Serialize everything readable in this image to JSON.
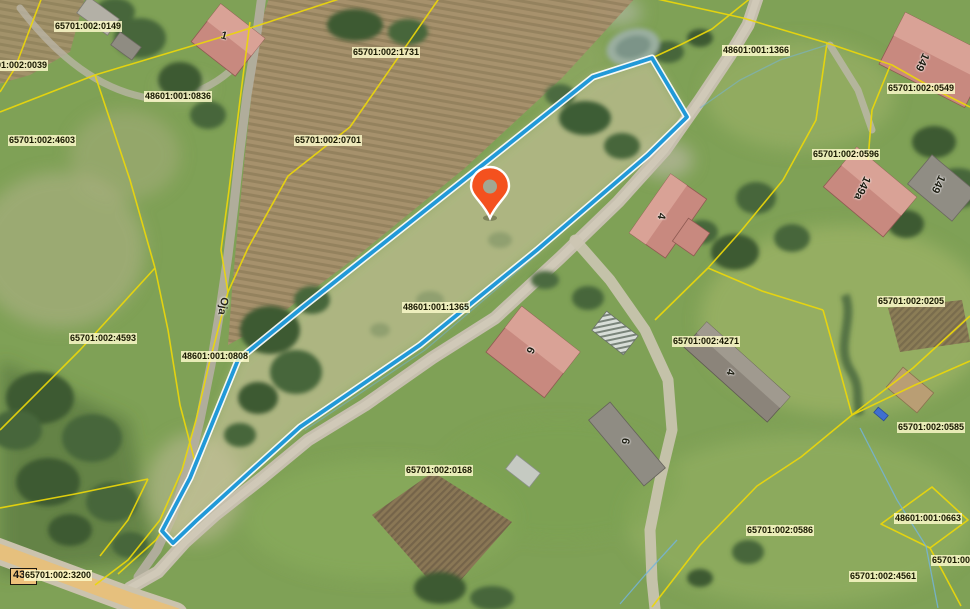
{
  "map": {
    "view": "aerial-cadastral",
    "selected_parcel": {
      "id": "48601:001:1365",
      "outline_color": "#2199d8"
    },
    "pin": {
      "color": "#f4511e"
    },
    "road": {
      "name": "Oja",
      "number": "43"
    },
    "cadastral": {
      "line_color": "#ecd70a",
      "label_background": "#fcf8c8"
    },
    "parcel_labels": [
      {
        "text": "65701:002:0149"
      },
      {
        "text": "65701:002:0039"
      },
      {
        "text": "48601:001:0836"
      },
      {
        "text": "65701:002:4603"
      },
      {
        "text": "65701:002:1731"
      },
      {
        "text": "65701:002:0701"
      },
      {
        "text": "48601:001:1366"
      },
      {
        "text": "65701:002:0549"
      },
      {
        "text": "65701:002:0596"
      },
      {
        "text": "65701:002:0205"
      },
      {
        "text": "65701:002:4271"
      },
      {
        "text": "48601:001:1365"
      },
      {
        "text": "65701:002:4593"
      },
      {
        "text": "48601:001:0808"
      },
      {
        "text": "65701:002:0168"
      },
      {
        "text": "65701:002:0586"
      },
      {
        "text": "48601:001:0663"
      },
      {
        "text": "65701:002:4561"
      },
      {
        "text": "65701:002:3200"
      },
      {
        "text": "65701:002:0585"
      },
      {
        "text": "65701:002:0"
      }
    ],
    "house_numbers": [
      {
        "text": "1"
      },
      {
        "text": "149"
      },
      {
        "text": "149a"
      },
      {
        "text": "149"
      },
      {
        "text": "4"
      },
      {
        "text": "6"
      },
      {
        "text": "4"
      },
      {
        "text": "6"
      }
    ]
  }
}
